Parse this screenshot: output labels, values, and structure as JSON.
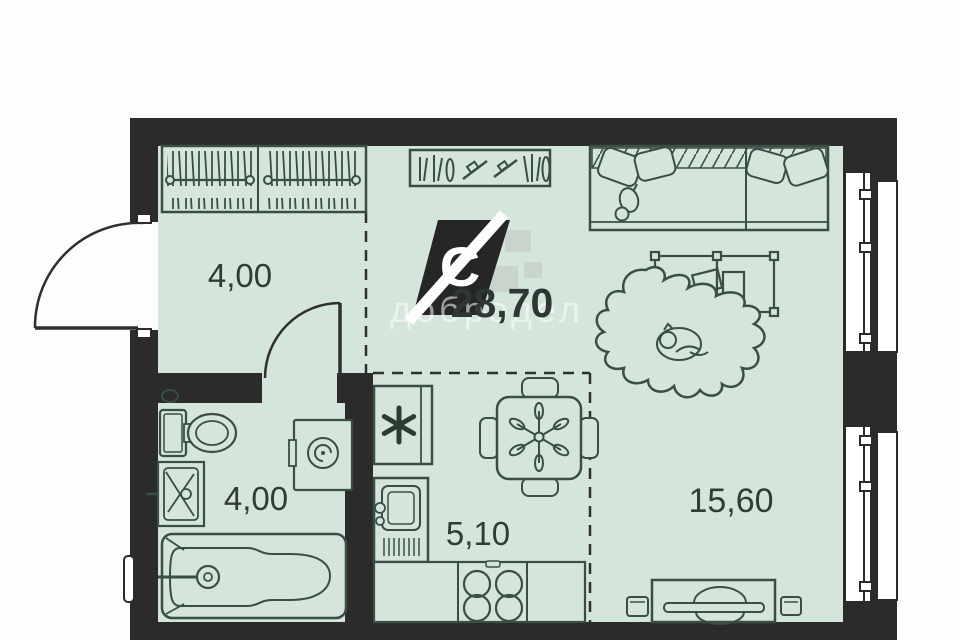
{
  "plan": {
    "title": "Studio apartment floor plan",
    "areas": {
      "hallway": "4,00",
      "bathroom": "4,00",
      "kitchen": "5,10",
      "living": "15,60",
      "total": "28,70"
    },
    "logo": {
      "letter": "C"
    },
    "watermark": {
      "text": "добродел"
    },
    "colors": {
      "floor": "#d4e5db",
      "wall": "#2b2b2b",
      "furniture_line": "#3a4e45",
      "label_text": "#333b37",
      "background": "#fdfdfd"
    },
    "icons": {
      "fridge": "snowflake-icon",
      "washing_machine": "spiral-drum-icon",
      "wardrobe": "hanger-rail-icon",
      "bookshelf": "books-icon",
      "stove": "four-burners-icon"
    }
  }
}
